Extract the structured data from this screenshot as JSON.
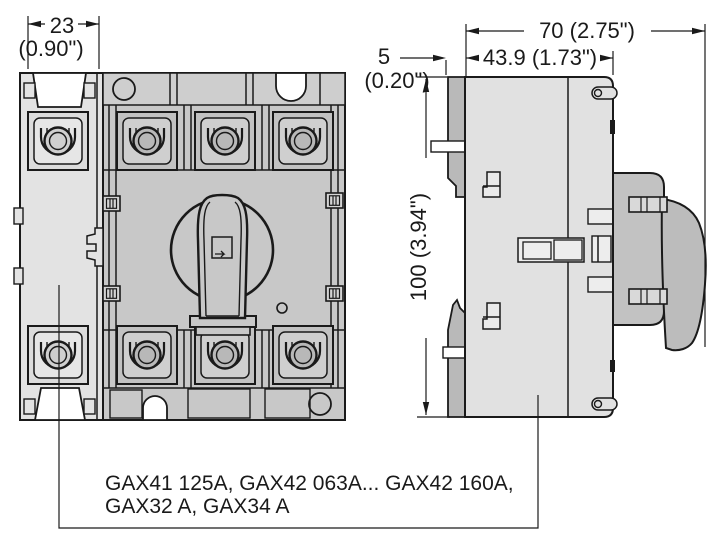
{
  "drawing": {
    "type": "dimensional-drawing",
    "product": "GAX switch disconnector, front and side views",
    "caption": {
      "line1": "GAX41 125A, GAX42 063A... GAX42 160A,",
      "line2": "GAX32 A, GAX34 A"
    },
    "dimensions": {
      "pole_width_mm": "23",
      "pole_width_inch": "(0.90\")",
      "flange_depth_mm": "5",
      "flange_depth_inch": "(0.20\")",
      "total_depth": "70 (2.75\")",
      "body_depth": "43.9 (1.73\")",
      "height": "100 (3.94\")"
    },
    "colors": {
      "outline": "#1a1a1a",
      "front_body": "#c8c8c8",
      "front_top_strip": "#cecece",
      "addon_pole": "#e3e3e3",
      "terminal_outer": "#c2c2c2",
      "terminal_inner": "#cfcfcf",
      "side_body": "#e1e1e1",
      "side_flange": "#b9b9b9",
      "handle_base": "#c2c2c2",
      "handle_knob": "#bcbcbc",
      "background": "#ffffff"
    }
  }
}
